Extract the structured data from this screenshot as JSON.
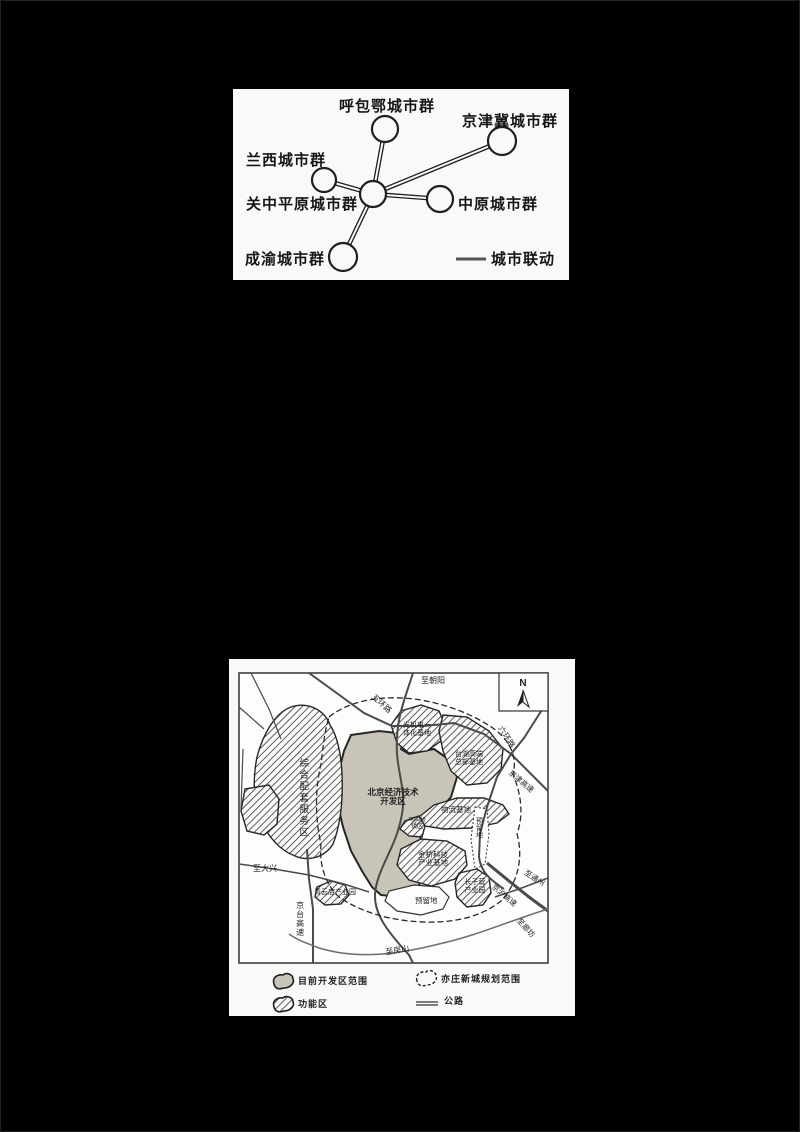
{
  "figure1": {
    "nodes": [
      {
        "label": "呼包鄂城市群"
      },
      {
        "label": "京津冀城市群"
      },
      {
        "label": "兰西城市群"
      },
      {
        "label": "关中平原城市群"
      },
      {
        "label": "中原城市群"
      },
      {
        "label": "成渝城市群"
      }
    ],
    "legend_label": "城市联动"
  },
  "figure2": {
    "compass": "N",
    "roads": {
      "to_chaoyang": "至朝阳",
      "wuhuan": "五环路",
      "liuhuan": "六环路",
      "jingjin_expwy": "京津高速",
      "to_tongzhou": "至通州",
      "jinghu_expwy": "京沪高速",
      "to_langfang": "至廊坊",
      "to_fangshan": "至房山",
      "jingtai_expwy": "京台高速",
      "to_daxing": "至大兴"
    },
    "regions": {
      "zonghe_fuwu": "综合配套服务区",
      "guangjidian": {
        "lines": [
          "光机电一",
          "体化基地"
        ]
      },
      "taihu": {
        "lines": [
          "台湖高端",
          "总部基地"
        ]
      },
      "kaifaqu": {
        "lines": [
          "北京经济技术",
          "开发区"
        ]
      },
      "wuliu": "物流基地",
      "majuqiao": {
        "lines": [
          "马驹桥",
          "镇区"
        ]
      },
      "jinqiao": {
        "lines": [
          "金桥科技",
          "产业基地"
        ]
      },
      "qingyundian": "青云店产业园",
      "changziying": {
        "lines": [
          "长子营",
          "产业园"
        ]
      },
      "yuliudi": "预留地",
      "yuliudi_east": "预留地"
    },
    "legend": {
      "current_area": "目前开发区范围",
      "functional_area": "功能区",
      "planning_area": "亦庄新城规划范围",
      "highway": "公路"
    },
    "colors": {
      "developed_fill": "#c9c4b8",
      "paper": "#f9f9f7",
      "ink": "#1f1f1f"
    }
  }
}
